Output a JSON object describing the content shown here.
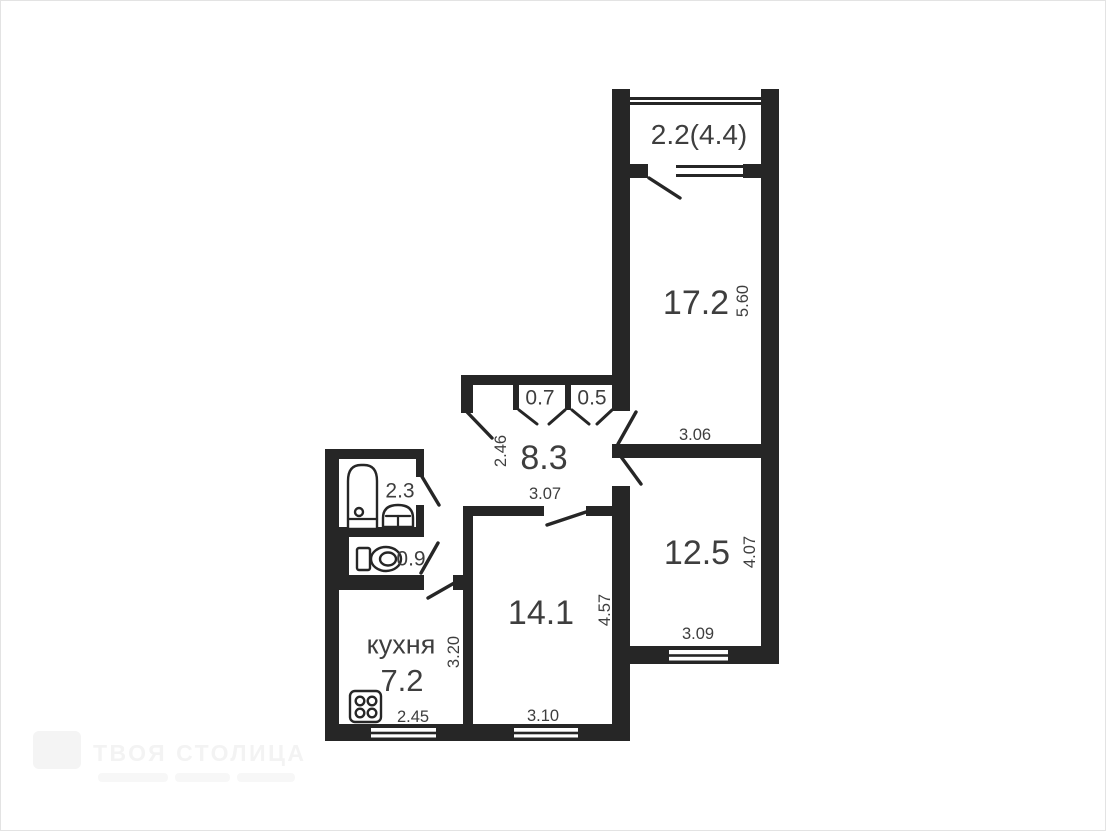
{
  "meta": {
    "type": "apartment-floor-plan",
    "units": "m"
  },
  "colors": {
    "background": "#ffffff",
    "wall": "#262626",
    "text": "#3e3e3e",
    "frame": "#e3e3e3",
    "watermark": "#f3f3f3"
  },
  "watermark": {
    "brand": "ТВОЯ СТОЛИЦА"
  },
  "rooms": {
    "balcony": {
      "area": "2.2(4.4)"
    },
    "living": {
      "area": "17.2",
      "depth": "5.60",
      "width": "3.06"
    },
    "hallway": {
      "area": "8.3",
      "depth": "2.46",
      "width": "3.07"
    },
    "closet_a": {
      "area": "0.7"
    },
    "closet_b": {
      "area": "0.5"
    },
    "bedroom": {
      "area": "12.5",
      "depth": "4.07",
      "width": "3.09"
    },
    "room2": {
      "area": "14.1",
      "depth": "4.57",
      "width": "3.10"
    },
    "bathroom": {
      "area": "2.3"
    },
    "wc": {
      "area": "0.9"
    },
    "kitchen": {
      "label": "кухня",
      "area": "7.2",
      "depth": "3.20",
      "width": "2.45"
    }
  }
}
